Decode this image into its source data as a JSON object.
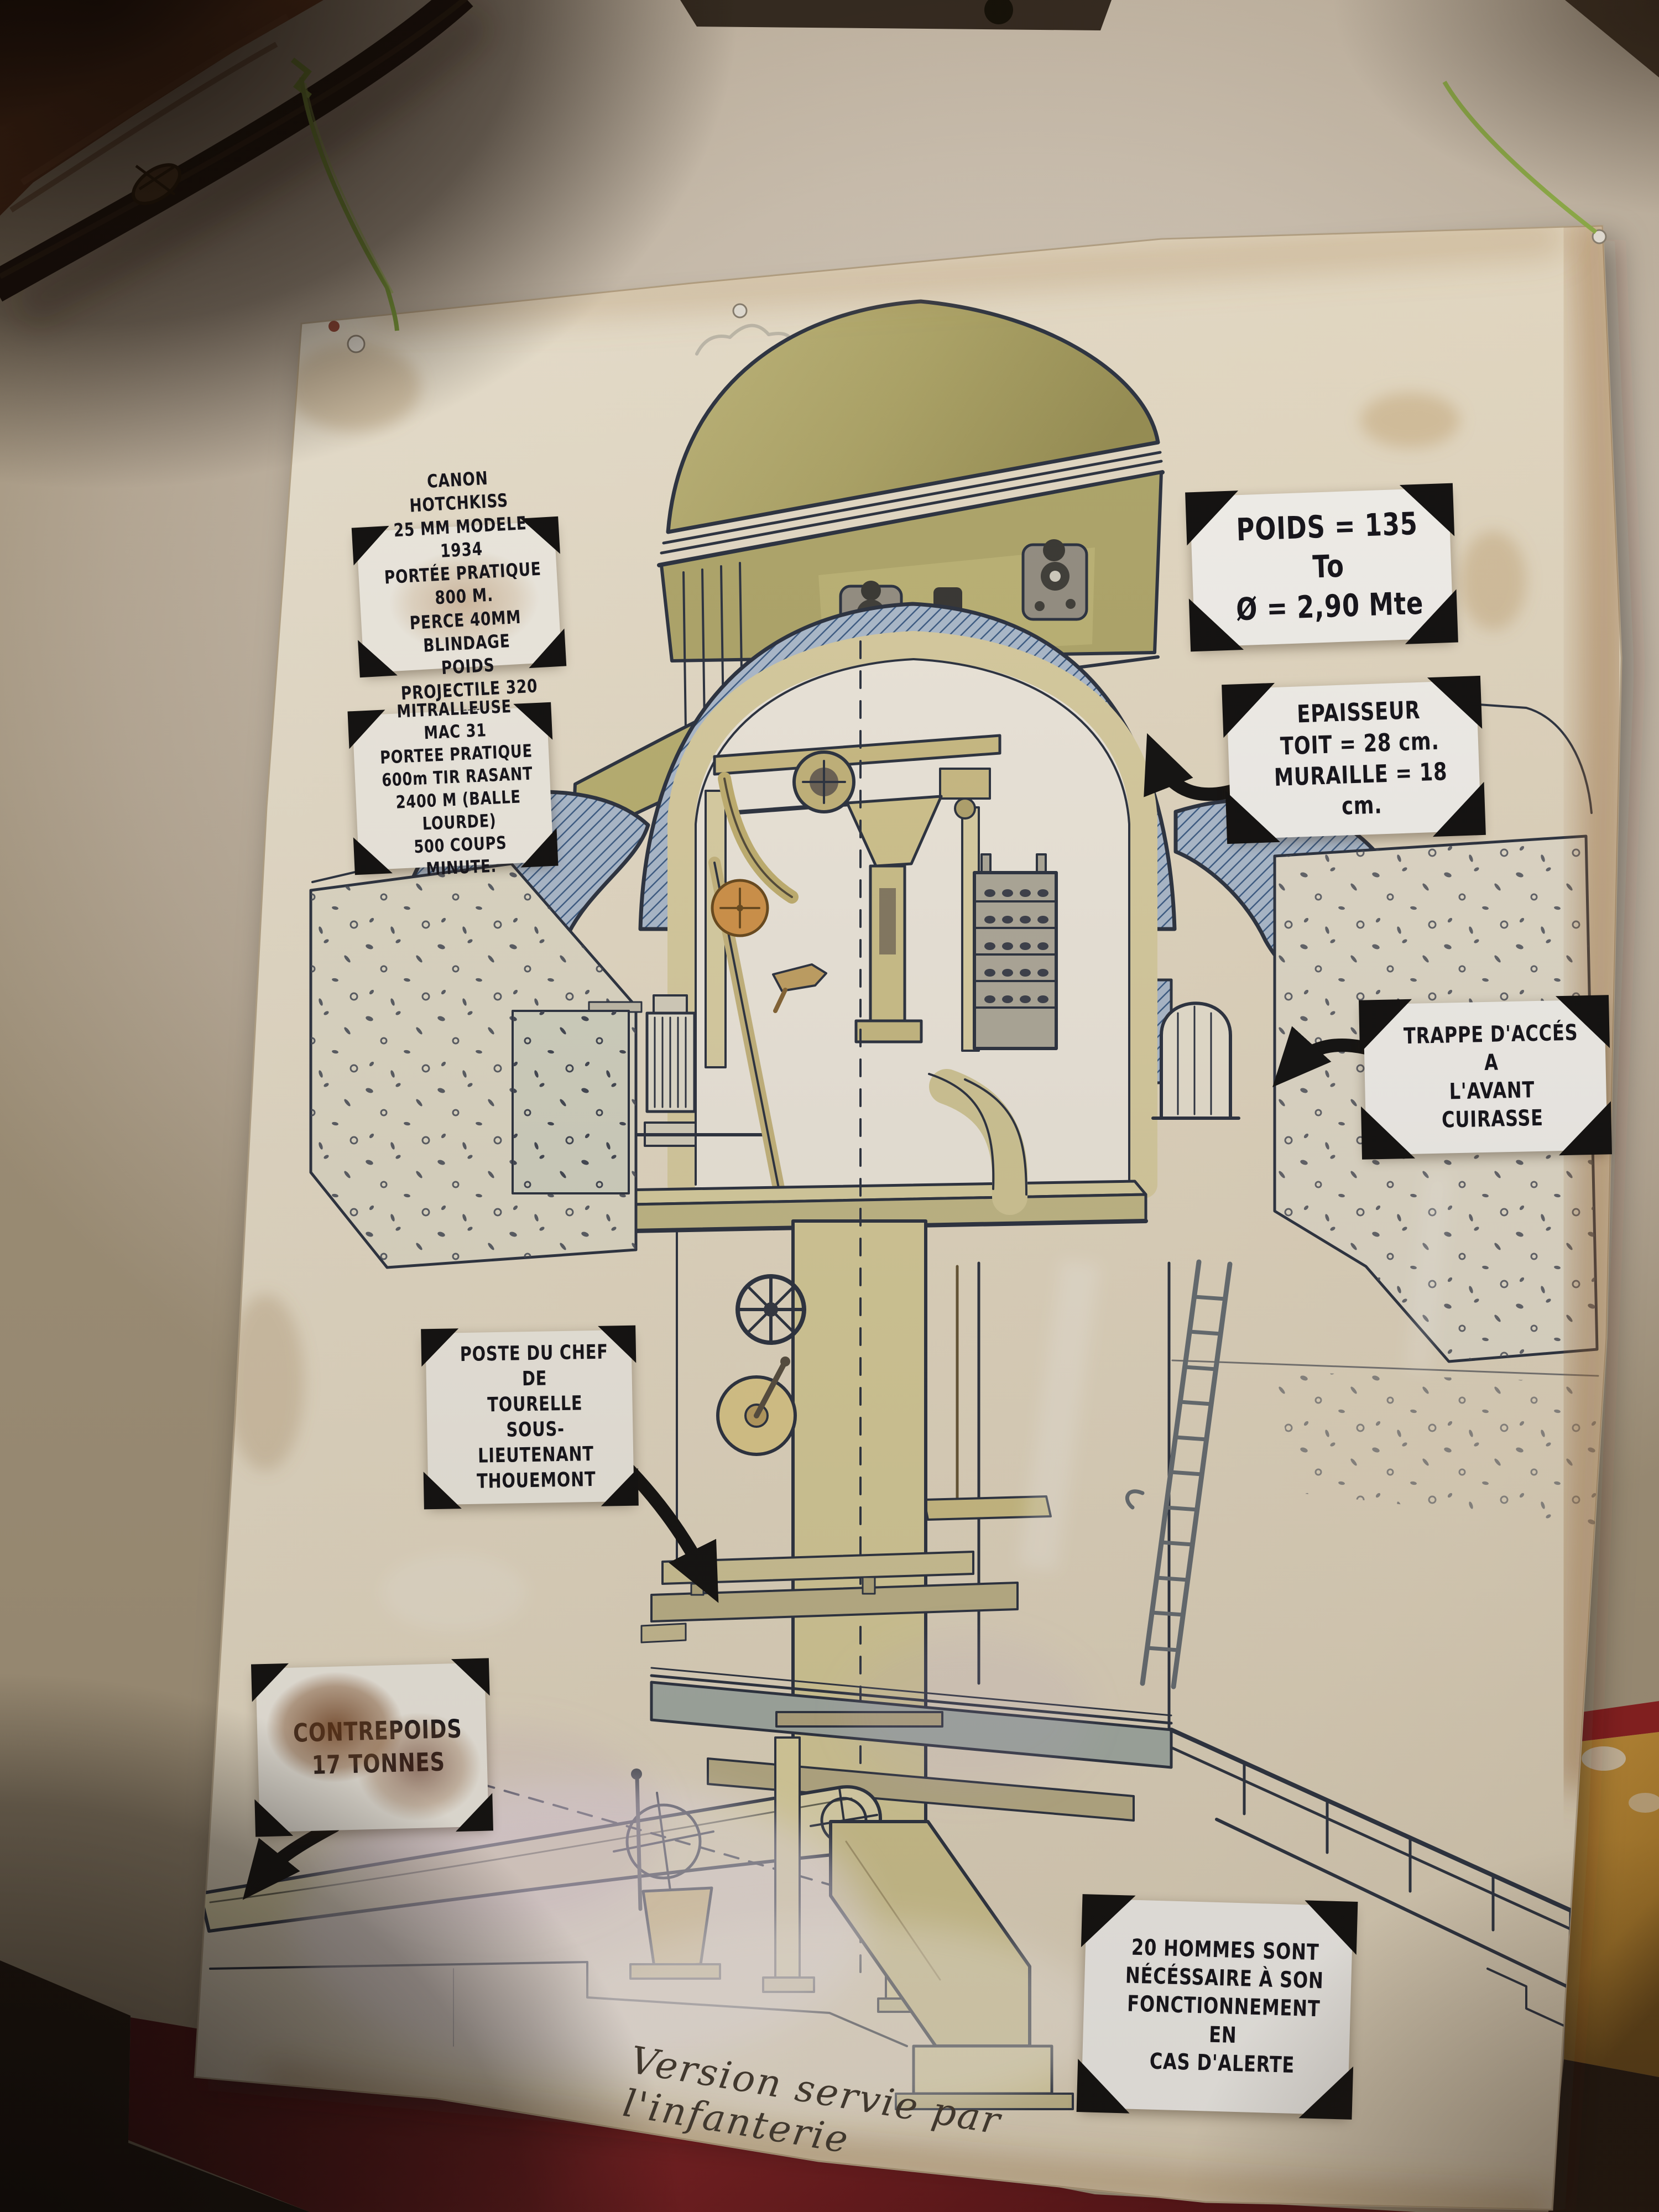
{
  "poster": {
    "cards": {
      "canon": {
        "text": "CANON HOTCHKISS\n25 MM MODELE 1934\nPORTÉE PRATIQUE 800 M.\nPERCE 40MM BLINDAGE\nPOIDS PROJECTILE 320 gr"
      },
      "mitrailleuse": {
        "text": "MITRALLEUSE\nMAC 31\nPORTEE PRATIQUE\n600m TIR RASANT\n2400 M (BALLE LOURDE)\n500 COUPS MINUTE."
      },
      "poids": {
        "text": "POIDS = 135 To\nØ = 2,90 Mte"
      },
      "epaisseur": {
        "text": "EPAISSEUR\nTOIT = 28 cm.\nMURAILLE = 18 cm."
      },
      "trappe": {
        "text": "TRAPPE D'ACCÉS\nA\nL'AVANT CUIRASSE"
      },
      "poste": {
        "text": "POSTE DU CHEF\nDE\nTOURELLE\nSOUS-LIEUTENANT\nTHOUEMONT"
      },
      "contrepoids": {
        "text": "CONTREPOIDS\n17 TONNES"
      },
      "hommes": {
        "text": "20 HOMMES SONT\nNÉCÉSSAIRE À SON\nFONCTIONNEMENT EN\nCAS D'ALERTE"
      }
    },
    "caption": "Version servie par l'infanterie"
  },
  "colors": {
    "wall": "#d2c7b8",
    "poster_paper": "#ece3d0",
    "ink_line": "#2e3645",
    "steel_hatch_blue": "#3f618c",
    "machinery_beige": "#d9cf9e",
    "dome_olive": "#b2aa6c",
    "orange_wheel": "#d89a4f",
    "wire_green": "#7fa23e",
    "red_band": "#6e1b1f",
    "ochre_panel": "#c9953c",
    "card_paper": "#f7f5ef",
    "marker_black": "#15151d",
    "stain_brown": "#a9763f",
    "rust": "#7c4526"
  }
}
